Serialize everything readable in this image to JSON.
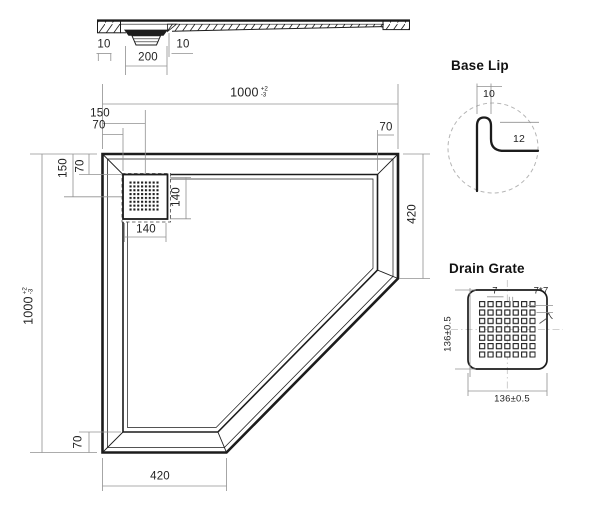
{
  "section_view": {
    "dim_left_lip": "10",
    "dim_drain_width": "200",
    "dim_right_lip": "10"
  },
  "plan_view": {
    "dim_width": "1000",
    "dim_width_tol_plus": "+2",
    "dim_width_tol_minus": "-3",
    "dim_height": "1000",
    "dim_height_tol_plus": "+2",
    "dim_height_tol_minus": "-3",
    "dim_drain_center_from_left": "150",
    "dim_drain_center_from_top": "150",
    "dim_rim_top_left": "70",
    "dim_rim_top_right": "70",
    "dim_rim_left": "70",
    "dim_rim_bottom": "70",
    "dim_drain_cutout_width": "140",
    "dim_drain_cutout_height": "140",
    "dim_right_edge": "420",
    "dim_bottom_edge": "420"
  },
  "base_lip_detail": {
    "title": "Base Lip",
    "dim_lip_width": "10",
    "dim_lip_height": "12"
  },
  "drain_grate_detail": {
    "title": "Drain Grate",
    "dim_hole_pitch": "7",
    "dim_hole_size": "7*7",
    "dim_hole_callout": "7",
    "dim_width": "136±0.5",
    "dim_height": "136±0.5"
  },
  "colors": {
    "object_line": "#1c1c1c",
    "dimension_line": "#909090",
    "background": "#ffffff"
  }
}
